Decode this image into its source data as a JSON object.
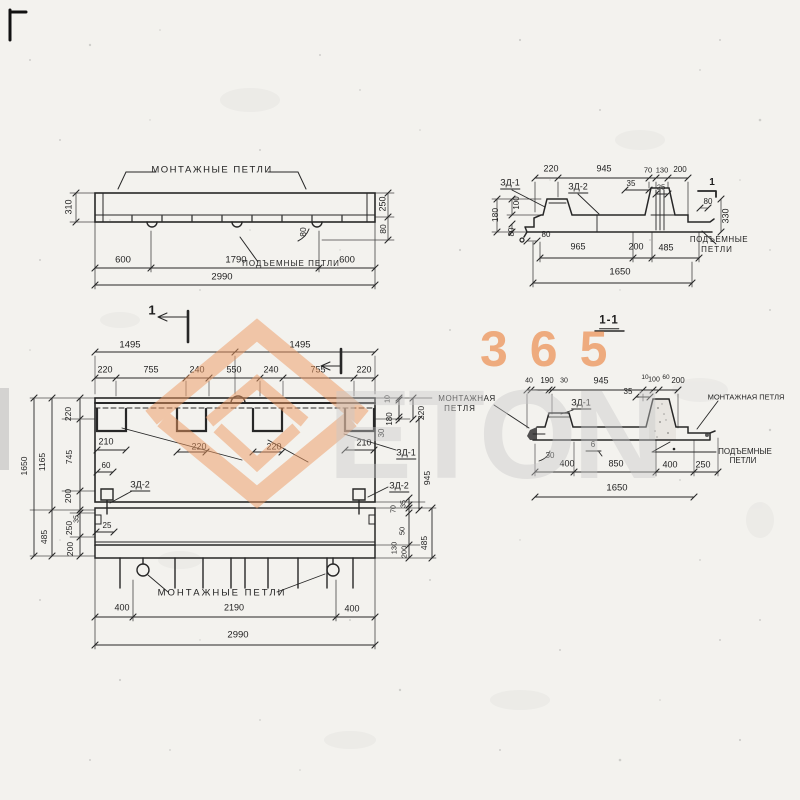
{
  "wm": {
    "n365": "365",
    "eton": "ETON",
    "orange": "#ee9a62",
    "gray": "#c9c9c9"
  },
  "d1": {
    "label_top": "МОНТАЖНЫЕ ПЕТЛИ",
    "lift": "ПОДЪЕМНЫЕ ПЕТЛИ",
    "h310": "310",
    "h250": "250",
    "h80": "80",
    "loop80": "80",
    "s600a": "600",
    "s1790": "1790",
    "s600b": "600",
    "total": "2990"
  },
  "d2": {
    "zd1": "ЗД-1",
    "zd2": "ЗД-2",
    "t220": "220",
    "t945": "945",
    "t70": "70",
    "t130": "130",
    "t200": "200",
    "t35": "35",
    "t25": "25",
    "l100": "100",
    "l180": "180",
    "l80": "80",
    "b80": "80",
    "r80": "80",
    "r330": "330",
    "sec": "1",
    "b965": "965",
    "b200": "200",
    "b485": "485",
    "total": "1650",
    "lift1": "ПОДЪЕМНЫЕ",
    "lift2": "ПЕТЛИ"
  },
  "pl": {
    "sec": "1",
    "t1495a": "1495",
    "t1495b": "1495",
    "r220a": "220",
    "r755a": "755",
    "r240a": "240",
    "r550": "550",
    "r240b": "240",
    "r755b": "755",
    "r220b": "220",
    "i210a": "210",
    "i220a": "220",
    "i220b": "220",
    "i210b": "210",
    "rs10": "10",
    "rs180": "180",
    "rs30": "30",
    "rs220": "220",
    "zd1": "ЗД-1",
    "rs945": "945",
    "zd2r": "ЗД-2",
    "rb70": "70",
    "rb35": "35",
    "rb50": "50",
    "rb130": "130",
    "rb200": "200",
    "rb485": "485",
    "zd2l": "ЗД-2",
    "d60": "60",
    "d25": "25",
    "ls220": "220",
    "ls745": "745",
    "ls200a": "200",
    "ls1165": "1165",
    "ls35": "35",
    "ls250": "250",
    "ls200b": "200",
    "ls485": "485",
    "ls1650": "1650",
    "label_bottom": "МОНТАЖНЫЕ ПЕТЛИ",
    "b400a": "400",
    "b2190": "2190",
    "b400b": "400",
    "total": "2990"
  },
  "s11": {
    "title": "1-1",
    "mountl1": "МОНТАЖНАЯ",
    "mountl2": "ПЕТЛЯ",
    "mountr": "МОНТАЖНАЯ ПЕТЛЯ",
    "zd1": "ЗД-1",
    "t40": "40",
    "t190": "190",
    "t30": "30",
    "t945": "945",
    "t10": "10",
    "t100": "100",
    "t60": "60",
    "t200": "200",
    "t35": "35",
    "d30": "30",
    "weld6": "6",
    "lift1": "ПОДЪЕМНЫЕ",
    "lift2": "ПЕТЛИ",
    "b400a": "400",
    "b850": "850",
    "b400b": "400",
    "b250": "250",
    "total": "1650"
  }
}
